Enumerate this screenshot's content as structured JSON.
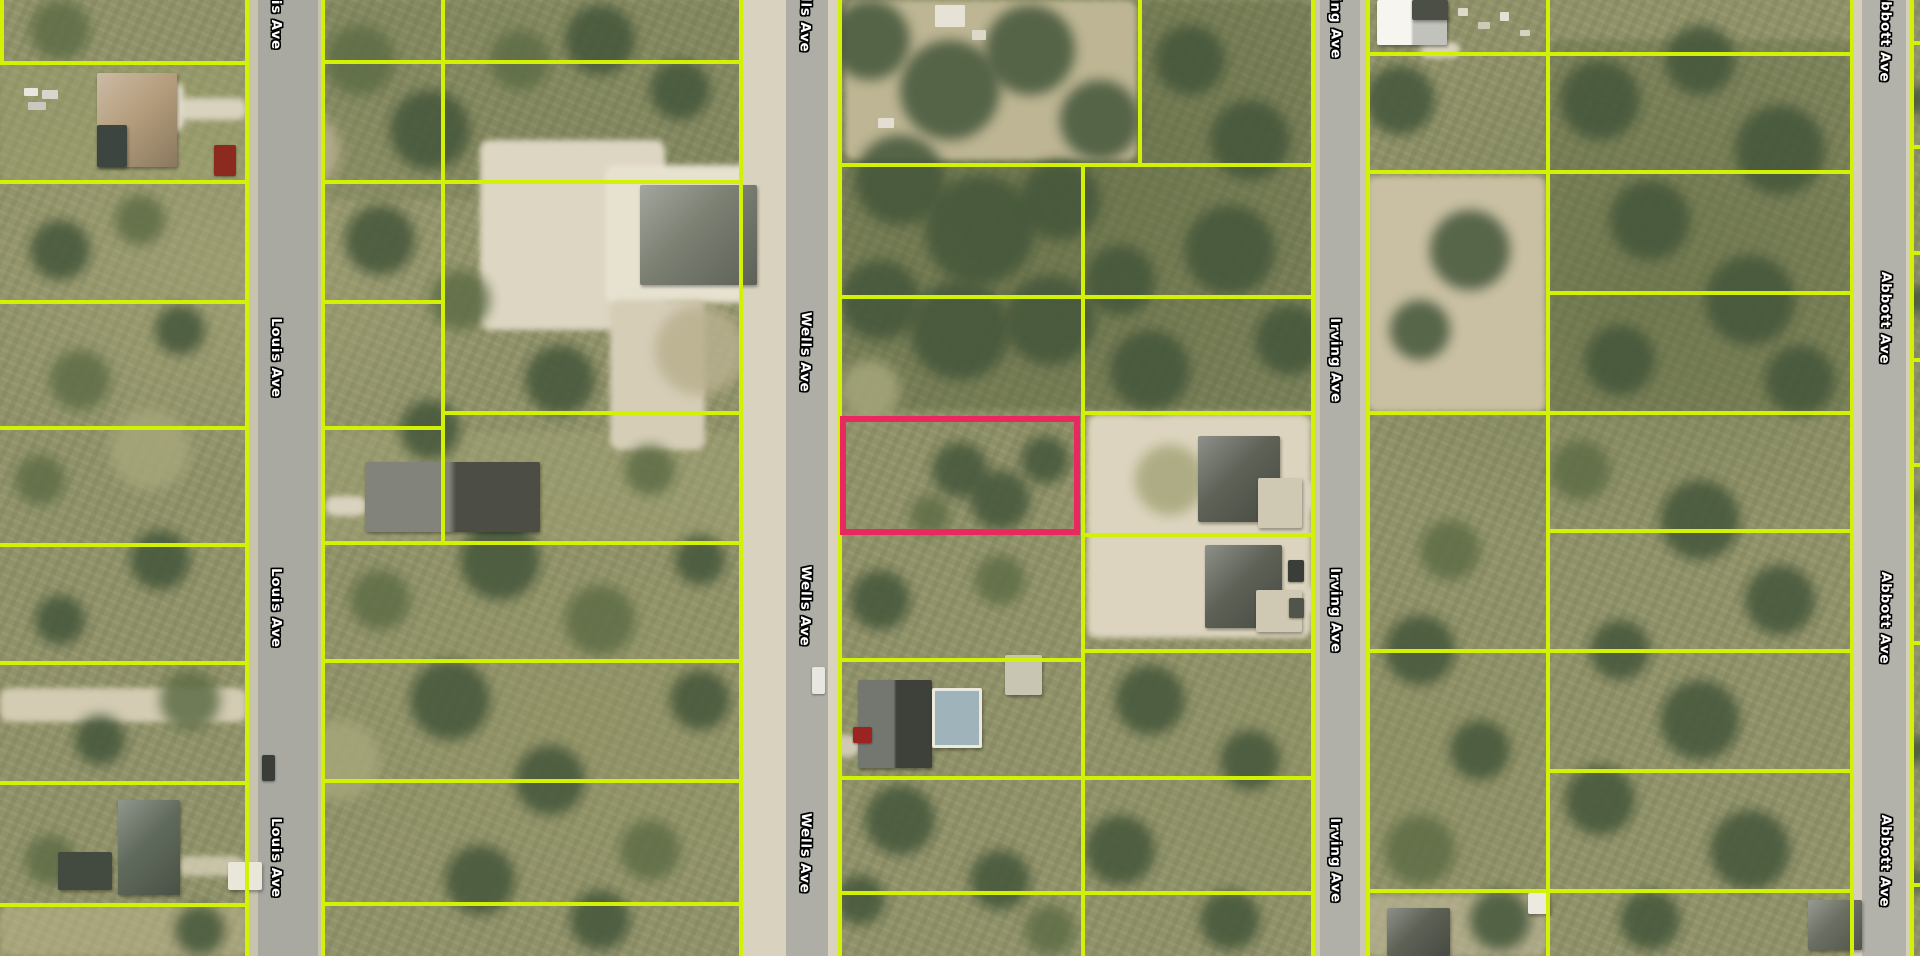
{
  "map": {
    "width": 1920,
    "height": 956,
    "view": "aerial-imagery-with-parcel-overlay",
    "parcel_line_color": "#d3f104",
    "highlight_color": "#e8285e"
  },
  "roads": [
    {
      "name": "Louis Ave",
      "x": 247,
      "w": 76,
      "pav_x": 258,
      "pav_w": 60,
      "shoulder": "#c8c3ae",
      "pavement": "#a9a9a2",
      "label_x": 284,
      "rot": 90,
      "labels_y": [
        -30,
        318,
        568,
        818
      ]
    },
    {
      "name": "Wells Ave",
      "x": 741,
      "w": 99,
      "pav_x": 786,
      "pav_w": 42,
      "shoulder": "#d9d2bf",
      "pavement": "#aeaea7",
      "label_x": 814,
      "rot": 91,
      "labels_y": [
        -28,
        312,
        566,
        813
      ]
    },
    {
      "name": "Irving Ave",
      "x": 1313,
      "w": 55,
      "pav_x": 1320,
      "pav_w": 40,
      "shoulder": "#cdc8b5",
      "pavement": "#b0b0a9",
      "label_x": 1343,
      "rot": 89.5,
      "labels_y": [
        -26,
        318,
        568,
        818
      ]
    },
    {
      "name": "Abbott Ave",
      "x": 1852,
      "w": 60,
      "pav_x": 1862,
      "pav_w": 44,
      "shoulder": "#d5cfbc",
      "pavement": "#b2b2ab",
      "label_x": 1894,
      "rot": 91,
      "labels_y": [
        -10,
        272,
        572,
        815
      ]
    }
  ],
  "highlight_parcel": {
    "x": 840,
    "y": 416,
    "w": 240,
    "h": 119,
    "stroke": "#e8285e",
    "stroke_width": 6
  },
  "parcel_lines": {
    "width": 4,
    "vertical": [
      {
        "x": 2,
        "y1": 0,
        "y2": 63
      },
      {
        "x": 247,
        "y1": 0,
        "y2": 956
      },
      {
        "x": 323,
        "y1": 0,
        "y2": 956
      },
      {
        "x": 443,
        "y1": 0,
        "y2": 543
      },
      {
        "x": 741,
        "y1": 0,
        "y2": 956
      },
      {
        "x": 840,
        "y1": 0,
        "y2": 956
      },
      {
        "x": 1140,
        "y1": 0,
        "y2": 165
      },
      {
        "x": 1083,
        "y1": 165,
        "y2": 956
      },
      {
        "x": 1313,
        "y1": 0,
        "y2": 956
      },
      {
        "x": 1368,
        "y1": 0,
        "y2": 956
      },
      {
        "x": 1548,
        "y1": 0,
        "y2": 956
      },
      {
        "x": 1852,
        "y1": 0,
        "y2": 956
      },
      {
        "x": 1912,
        "y1": 0,
        "y2": 956
      }
    ],
    "horizontal": [
      {
        "y": 63,
        "x1": 0,
        "x2": 247
      },
      {
        "y": 182,
        "x1": 0,
        "x2": 247
      },
      {
        "y": 302,
        "x1": 0,
        "x2": 247
      },
      {
        "y": 428,
        "x1": 0,
        "x2": 247
      },
      {
        "y": 545,
        "x1": 0,
        "x2": 247
      },
      {
        "y": 663,
        "x1": 0,
        "x2": 247
      },
      {
        "y": 783,
        "x1": 0,
        "x2": 247
      },
      {
        "y": 905,
        "x1": 0,
        "x2": 247
      },
      {
        "y": 62,
        "x1": 323,
        "x2": 741
      },
      {
        "y": 182,
        "x1": 323,
        "x2": 741
      },
      {
        "y": 302,
        "x1": 323,
        "x2": 443
      },
      {
        "y": 428,
        "x1": 323,
        "x2": 443
      },
      {
        "y": 413,
        "x1": 443,
        "x2": 741
      },
      {
        "y": 543,
        "x1": 323,
        "x2": 741
      },
      {
        "y": 661,
        "x1": 323,
        "x2": 741
      },
      {
        "y": 781,
        "x1": 323,
        "x2": 741
      },
      {
        "y": 904,
        "x1": 323,
        "x2": 741
      },
      {
        "y": 165,
        "x1": 840,
        "x2": 1313
      },
      {
        "y": 297,
        "x1": 840,
        "x2": 1313
      },
      {
        "y": 413,
        "x1": 1083,
        "x2": 1313
      },
      {
        "y": 535,
        "x1": 1083,
        "x2": 1313
      },
      {
        "y": 651,
        "x1": 1083,
        "x2": 1313
      },
      {
        "y": 660,
        "x1": 840,
        "x2": 1083
      },
      {
        "y": 778,
        "x1": 840,
        "x2": 1313
      },
      {
        "y": 893,
        "x1": 840,
        "x2": 1313
      },
      {
        "y": 54,
        "x1": 1368,
        "x2": 1852
      },
      {
        "y": 172,
        "x1": 1368,
        "x2": 1852
      },
      {
        "y": 413,
        "x1": 1368,
        "x2": 1852
      },
      {
        "y": 651,
        "x1": 1368,
        "x2": 1852
      },
      {
        "y": 891,
        "x1": 1368,
        "x2": 1852
      },
      {
        "y": 293,
        "x1": 1548,
        "x2": 1852
      },
      {
        "y": 531,
        "x1": 1548,
        "x2": 1852
      },
      {
        "y": 771,
        "x1": 1548,
        "x2": 1852
      },
      {
        "y": 43,
        "x1": 1912,
        "x2": 1920
      },
      {
        "y": 147,
        "x1": 1912,
        "x2": 1920
      },
      {
        "y": 253,
        "x1": 1912,
        "x2": 1920
      },
      {
        "y": 360,
        "x1": 1912,
        "x2": 1920
      },
      {
        "y": 465,
        "x1": 1912,
        "x2": 1920
      },
      {
        "y": 643,
        "x1": 1912,
        "x2": 1920
      },
      {
        "y": 885,
        "x1": 1912,
        "x2": 1920
      }
    ]
  },
  "terrain_patches": [
    {
      "x": 840,
      "y": 0,
      "w": 473,
      "h": 410,
      "c": "rgba(66,82,48,0.30)"
    },
    {
      "x": 1548,
      "y": 40,
      "w": 304,
      "h": 375,
      "c": "rgba(66,82,48,0.25)"
    },
    {
      "x": 323,
      "y": 0,
      "w": 418,
      "h": 200,
      "c": "rgba(80,92,56,0.18)"
    },
    {
      "x": 845,
      "y": 0,
      "w": 292,
      "h": 160,
      "c": "#bdb593"
    },
    {
      "x": 0,
      "y": 63,
      "w": 247,
      "h": 119,
      "c": "rgba(160,165,110,0.35)"
    },
    {
      "x": 323,
      "y": 432,
      "w": 418,
      "h": 110,
      "c": "rgba(168,168,120,0.35)"
    },
    {
      "x": 480,
      "y": 140,
      "w": 185,
      "h": 190,
      "c": "#ddd6c2"
    },
    {
      "x": 605,
      "y": 165,
      "w": 168,
      "h": 138,
      "c": "#e7e1d0"
    },
    {
      "x": 610,
      "y": 300,
      "w": 95,
      "h": 150,
      "c": "#d5cdb6"
    },
    {
      "x": 1087,
      "y": 414,
      "w": 224,
      "h": 224,
      "c": "#dcd4be"
    },
    {
      "x": 1367,
      "y": 176,
      "w": 179,
      "h": 236,
      "c": "#c9bfa2"
    },
    {
      "x": 0,
      "y": 688,
      "w": 247,
      "h": 34,
      "c": "#d3cbb2"
    },
    {
      "x": 0,
      "y": 905,
      "w": 247,
      "h": 51,
      "c": "rgba(190,180,140,0.55)"
    },
    {
      "x": 1357,
      "y": 895,
      "w": 190,
      "h": 61,
      "c": "rgba(195,187,156,0.6)"
    },
    {
      "x": 177,
      "y": 98,
      "w": 70,
      "h": 22,
      "c": "#d8d2be"
    },
    {
      "x": 150,
      "y": 82,
      "w": 34,
      "h": 50,
      "c": "#e0dac8"
    },
    {
      "x": 325,
      "y": 496,
      "w": 42,
      "h": 20,
      "c": "#d8d2be"
    },
    {
      "x": 828,
      "y": 735,
      "w": 32,
      "h": 22,
      "c": "#cfc9b6"
    },
    {
      "x": 1302,
      "y": 482,
      "w": 12,
      "h": 28,
      "c": "#d8d2be"
    },
    {
      "x": 1302,
      "y": 586,
      "w": 12,
      "h": 28,
      "c": "#d8d2be"
    },
    {
      "x": 1420,
      "y": 42,
      "w": 40,
      "h": 16,
      "c": "#d8d2be"
    },
    {
      "x": 177,
      "y": 856,
      "w": 68,
      "h": 20,
      "c": "rgba(215,208,184,0.8)"
    }
  ],
  "tree_palette": {
    "d": "#44563a",
    "m": "#5e6d46",
    "g": "#a6a67a",
    "t": "#b9b08f"
  },
  "tree_blobs": [
    [
      870,
      40,
      40,
      "d"
    ],
    [
      950,
      90,
      50,
      "d"
    ],
    [
      1030,
      50,
      45,
      "d"
    ],
    [
      1100,
      120,
      40,
      "d"
    ],
    [
      900,
      180,
      45,
      "d"
    ],
    [
      980,
      230,
      55,
      "d"
    ],
    [
      1060,
      200,
      40,
      "d"
    ],
    [
      880,
      300,
      40,
      "d"
    ],
    [
      960,
      330,
      50,
      "d"
    ],
    [
      1050,
      320,
      45,
      "d"
    ],
    [
      1120,
      280,
      35,
      "d"
    ],
    [
      1190,
      60,
      35,
      "d"
    ],
    [
      1250,
      140,
      40,
      "d"
    ],
    [
      1230,
      250,
      45,
      "d"
    ],
    [
      1290,
      340,
      35,
      "d"
    ],
    [
      1150,
      370,
      40,
      "d"
    ],
    [
      960,
      470,
      28,
      "d"
    ],
    [
      1000,
      500,
      30,
      "d"
    ],
    [
      1045,
      460,
      24,
      "d"
    ],
    [
      930,
      515,
      20,
      "m"
    ],
    [
      360,
      60,
      35,
      "m"
    ],
    [
      430,
      130,
      40,
      "d"
    ],
    [
      520,
      60,
      30,
      "m"
    ],
    [
      600,
      40,
      35,
      "d"
    ],
    [
      680,
      90,
      30,
      "d"
    ],
    [
      380,
      240,
      35,
      "d"
    ],
    [
      460,
      300,
      30,
      "m"
    ],
    [
      560,
      380,
      35,
      "d"
    ],
    [
      430,
      430,
      30,
      "d"
    ],
    [
      650,
      470,
      25,
      "m"
    ],
    [
      500,
      560,
      40,
      "d"
    ],
    [
      600,
      620,
      35,
      "m"
    ],
    [
      450,
      700,
      40,
      "d"
    ],
    [
      550,
      780,
      35,
      "d"
    ],
    [
      650,
      850,
      30,
      "m"
    ],
    [
      480,
      880,
      35,
      "d"
    ],
    [
      380,
      600,
      30,
      "m"
    ],
    [
      700,
      700,
      30,
      "d"
    ],
    [
      600,
      920,
      30,
      "d"
    ],
    [
      700,
      560,
      25,
      "d"
    ],
    [
      60,
      30,
      30,
      "m"
    ],
    [
      140,
      220,
      25,
      "m"
    ],
    [
      60,
      250,
      30,
      "d"
    ],
    [
      180,
      330,
      25,
      "d"
    ],
    [
      80,
      380,
      30,
      "m"
    ],
    [
      40,
      480,
      25,
      "m"
    ],
    [
      160,
      560,
      30,
      "d"
    ],
    [
      60,
      620,
      25,
      "d"
    ],
    [
      190,
      700,
      30,
      "m"
    ],
    [
      100,
      740,
      25,
      "d"
    ],
    [
      50,
      860,
      25,
      "m"
    ],
    [
      200,
      930,
      25,
      "d"
    ],
    [
      1400,
      100,
      35,
      "d"
    ],
    [
      1470,
      250,
      40,
      "d"
    ],
    [
      1420,
      330,
      30,
      "d"
    ],
    [
      1600,
      100,
      40,
      "d"
    ],
    [
      1700,
      60,
      35,
      "d"
    ],
    [
      1780,
      150,
      45,
      "d"
    ],
    [
      1650,
      220,
      40,
      "d"
    ],
    [
      1750,
      300,
      45,
      "d"
    ],
    [
      1620,
      360,
      35,
      "d"
    ],
    [
      1800,
      380,
      35,
      "d"
    ],
    [
      1580,
      470,
      30,
      "m"
    ],
    [
      1700,
      520,
      40,
      "d"
    ],
    [
      1780,
      600,
      35,
      "d"
    ],
    [
      1620,
      650,
      30,
      "d"
    ],
    [
      1700,
      720,
      40,
      "d"
    ],
    [
      1600,
      800,
      35,
      "d"
    ],
    [
      1750,
      850,
      40,
      "d"
    ],
    [
      1650,
      920,
      30,
      "d"
    ],
    [
      1450,
      550,
      30,
      "m"
    ],
    [
      1420,
      650,
      35,
      "d"
    ],
    [
      1480,
      750,
      30,
      "d"
    ],
    [
      1420,
      850,
      35,
      "m"
    ],
    [
      1500,
      920,
      30,
      "d"
    ],
    [
      880,
      600,
      30,
      "d"
    ],
    [
      1000,
      580,
      25,
      "m"
    ],
    [
      1150,
      700,
      35,
      "d"
    ],
    [
      1250,
      760,
      30,
      "d"
    ],
    [
      900,
      820,
      35,
      "d"
    ],
    [
      1000,
      880,
      30,
      "d"
    ],
    [
      1120,
      850,
      35,
      "d"
    ],
    [
      1230,
      920,
      30,
      "d"
    ],
    [
      1050,
      930,
      25,
      "m"
    ],
    [
      860,
      900,
      25,
      "d"
    ],
    [
      300,
      150,
      40,
      "t"
    ],
    [
      700,
      350,
      45,
      "t"
    ],
    [
      150,
      450,
      40,
      "g"
    ],
    [
      340,
      760,
      40,
      "g"
    ],
    [
      870,
      390,
      30,
      "g"
    ],
    [
      1170,
      480,
      35,
      "g"
    ],
    [
      1916,
      100,
      15,
      "d"
    ],
    [
      1916,
      300,
      15,
      "d"
    ],
    [
      1916,
      500,
      12,
      "m"
    ],
    [
      1916,
      750,
      15,
      "d"
    ],
    [
      1916,
      880,
      12,
      "d"
    ]
  ],
  "structures": [
    {
      "name": "house-roof",
      "x": 97,
      "y": 73,
      "w": 80,
      "h": 94,
      "c": "#b59e7d",
      "type": "hip"
    },
    {
      "name": "pool-screen",
      "x": 97,
      "y": 125,
      "w": 30,
      "h": 42,
      "c": "#3c4540",
      "type": "flat"
    },
    {
      "name": "house-roof",
      "x": 365,
      "y": 462,
      "w": 175,
      "h": 70,
      "c": "#5f6257",
      "type": "gable"
    },
    {
      "name": "house-roof",
      "x": 118,
      "y": 800,
      "w": 62,
      "h": 95,
      "c": "#606a5c",
      "type": "hip"
    },
    {
      "name": "shed",
      "x": 58,
      "y": 852,
      "w": 54,
      "h": 38,
      "c": "#434a40",
      "type": "flat"
    },
    {
      "name": "shed",
      "x": 228,
      "y": 862,
      "w": 34,
      "h": 28,
      "c": "#e9e6da",
      "type": "flat"
    },
    {
      "name": "house-roof",
      "x": 640,
      "y": 185,
      "w": 117,
      "h": 100,
      "c": "#7b7f72",
      "type": "hip"
    },
    {
      "name": "house-roof",
      "x": 1198,
      "y": 436,
      "w": 82,
      "h": 86,
      "c": "#5d6156",
      "type": "hip"
    },
    {
      "name": "concrete-pad",
      "x": 1258,
      "y": 478,
      "w": 44,
      "h": 50,
      "c": "#cfc8b2",
      "type": "flat"
    },
    {
      "name": "house-roof",
      "x": 1205,
      "y": 545,
      "w": 77,
      "h": 83,
      "c": "#5d6156",
      "type": "hip"
    },
    {
      "name": "concrete-pad",
      "x": 1256,
      "y": 590,
      "w": 46,
      "h": 42,
      "c": "#cfc8b2",
      "type": "flat"
    },
    {
      "name": "house-roof",
      "x": 858,
      "y": 680,
      "w": 74,
      "h": 88,
      "c": "#4c5148",
      "type": "gable"
    },
    {
      "name": "pool-enclosure",
      "x": 932,
      "y": 688,
      "w": 50,
      "h": 60,
      "c": "#9fb4ba",
      "type": "pool"
    },
    {
      "name": "shed",
      "x": 1005,
      "y": 655,
      "w": 37,
      "h": 40,
      "c": "#c9c5b3",
      "type": "flat"
    },
    {
      "name": "house-roof",
      "x": 1377,
      "y": 0,
      "w": 70,
      "h": 45,
      "c": "#f3f2ec",
      "type": "gable"
    },
    {
      "name": "roof-section",
      "x": 1412,
      "y": 0,
      "w": 36,
      "h": 20,
      "c": "#4b4f45",
      "type": "flat"
    },
    {
      "name": "house-roof",
      "x": 1387,
      "y": 908,
      "w": 63,
      "h": 48,
      "c": "#5d6156",
      "type": "hip"
    },
    {
      "name": "shed",
      "x": 1528,
      "y": 893,
      "w": 22,
      "h": 21,
      "c": "#ece9df",
      "type": "flat"
    },
    {
      "name": "house-roof",
      "x": 1808,
      "y": 900,
      "w": 54,
      "h": 50,
      "c": "#6b6f62",
      "type": "hip"
    }
  ],
  "vehicles": [
    {
      "x": 214,
      "y": 145,
      "w": 22,
      "h": 31,
      "c": "#8d2a20"
    },
    {
      "x": 262,
      "y": 755,
      "w": 13,
      "h": 26,
      "c": "#3a3d38"
    },
    {
      "x": 812,
      "y": 667,
      "w": 13,
      "h": 27,
      "c": "#e8e6e0"
    },
    {
      "x": 853,
      "y": 727,
      "w": 19,
      "h": 16,
      "c": "#9b2420"
    },
    {
      "x": 1288,
      "y": 560,
      "w": 16,
      "h": 22,
      "c": "#3a3d38"
    },
    {
      "x": 1289,
      "y": 598,
      "w": 15,
      "h": 20,
      "c": "#50544a"
    }
  ],
  "debris": [
    {
      "x": 24,
      "y": 88,
      "w": 14,
      "h": 8,
      "c": "#e8e6df"
    },
    {
      "x": 42,
      "y": 90,
      "w": 16,
      "h": 9,
      "c": "#d8d6cc"
    },
    {
      "x": 28,
      "y": 102,
      "w": 18,
      "h": 8,
      "c": "#c8c8c0"
    },
    {
      "x": 1458,
      "y": 8,
      "w": 10,
      "h": 8,
      "c": "#ddd8c8"
    },
    {
      "x": 1478,
      "y": 22,
      "w": 12,
      "h": 7,
      "c": "#cfc9b8"
    },
    {
      "x": 1500,
      "y": 12,
      "w": 9,
      "h": 9,
      "c": "#e4e0d2"
    },
    {
      "x": 1520,
      "y": 30,
      "w": 10,
      "h": 6,
      "c": "#d8d2c0"
    },
    {
      "x": 935,
      "y": 5,
      "w": 30,
      "h": 22,
      "c": "#e6e3d6"
    },
    {
      "x": 972,
      "y": 30,
      "w": 14,
      "h": 10,
      "c": "#dcd8ca"
    },
    {
      "x": 878,
      "y": 118,
      "w": 16,
      "h": 10,
      "c": "#e2dfd2"
    }
  ]
}
